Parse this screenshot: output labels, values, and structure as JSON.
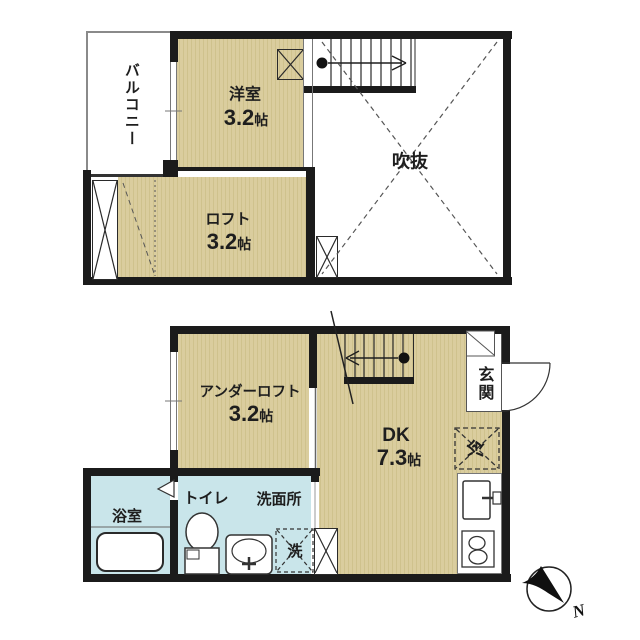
{
  "colors": {
    "room_fill": "#dacd9e",
    "room_stripe": "#cfc28d",
    "wet_area_fill": "#c9e5ea",
    "wall": "#1b1b1b",
    "line": "#444444"
  },
  "upper_floor": {
    "balcony": {
      "label": "バルコニー"
    },
    "western_room": {
      "label": "洋室",
      "size": "3.2",
      "unit": "帖"
    },
    "loft": {
      "label": "ロフト",
      "size": "3.2",
      "unit": "帖"
    },
    "atrium": {
      "label": "吹抜"
    }
  },
  "lower_floor": {
    "under_loft": {
      "label": "アンダーロフト",
      "size": "3.2",
      "unit": "帖"
    },
    "dining_kitchen": {
      "label": "DK",
      "size": "7.3",
      "unit": "帖"
    },
    "entrance": {
      "label": "玄関"
    },
    "refrigerator": {
      "label": "冷"
    },
    "bathroom": {
      "label": "浴室"
    },
    "toilet": {
      "label": "トイレ"
    },
    "washroom": {
      "label": "洗面所"
    },
    "washer": {
      "label": "洗"
    }
  },
  "compass": {
    "north_label": "N"
  }
}
